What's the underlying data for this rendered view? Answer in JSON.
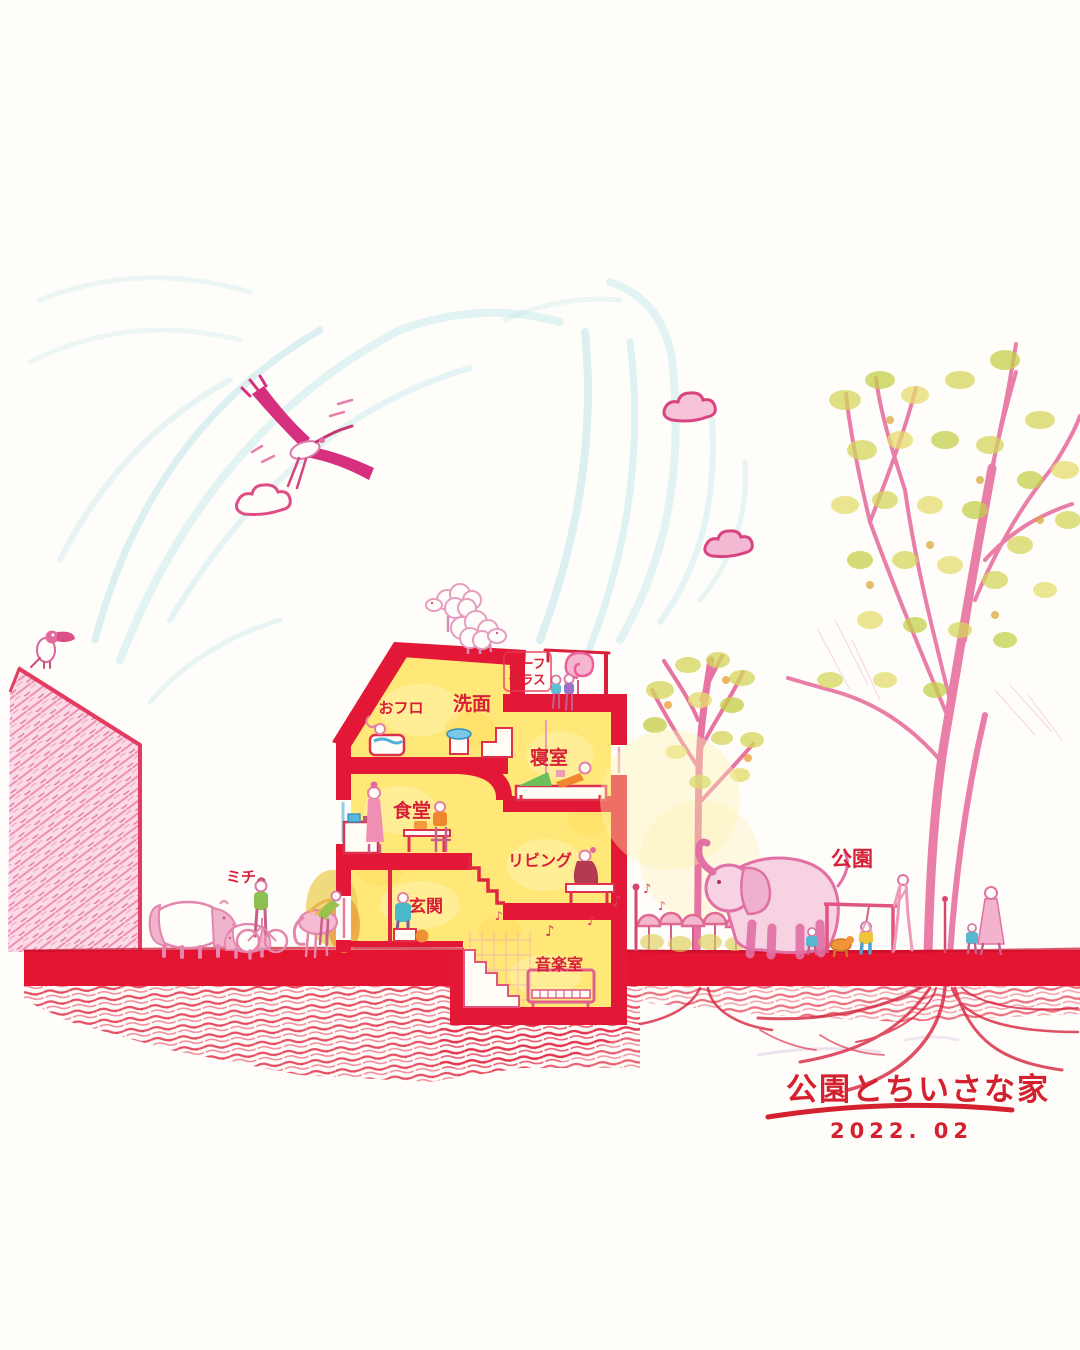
{
  "artwork": {
    "title": "公園とちいさな家",
    "date": "2022. 02",
    "room_labels": {
      "roof_terrace_line1": "ルーフ",
      "roof_terrace_line2": "テラス",
      "washroom": "洗面",
      "bath": "おフロ",
      "bedroom": "寝室",
      "dining": "食堂",
      "living": "リビング",
      "entrance": "玄関",
      "music_room": "音楽室"
    },
    "site_labels": {
      "street": "ミチ",
      "park": "公園"
    },
    "music_note": "♪",
    "palette": {
      "wall_red": "#e31836",
      "label_red": "#d81f38",
      "outline_pink": "#e170a5",
      "interior_yellow": "#ffe878",
      "sky_blue": "#b9e4e9",
      "leaf_green": "#cfd355",
      "accent_orange": "#f0862d",
      "water_blue": "#5bb8dd",
      "paper_white": "#fffdfa"
    }
  }
}
